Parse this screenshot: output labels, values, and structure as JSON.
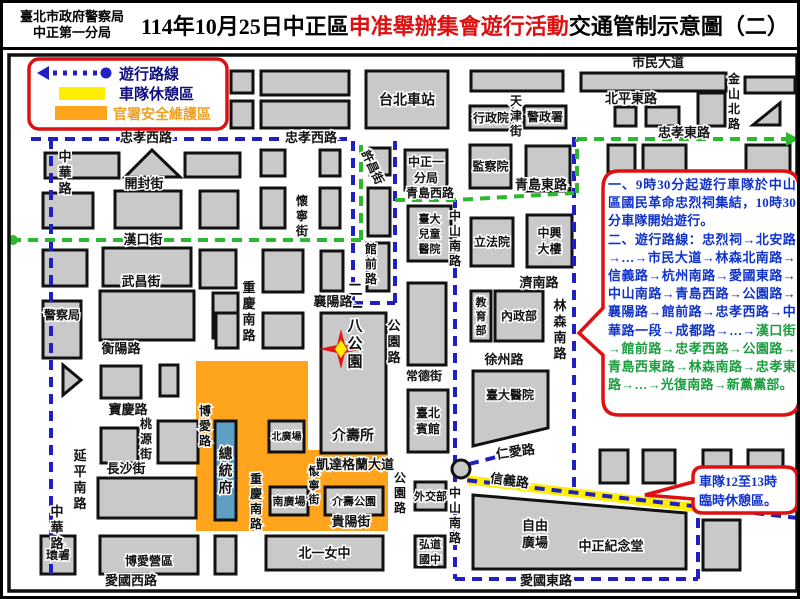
{
  "title": {
    "agency_line1": "臺北市政府警察局",
    "agency_line2": "中正第一分局",
    "part1": "114年10月25日中正區",
    "part2_red": "申准舉辦集會遊行活動",
    "part3": "交通管制示意圖（二）"
  },
  "legend": {
    "route_label": "遊行路線",
    "rest_label": "車隊休憩區",
    "security_label": "官署安全維護區"
  },
  "notes": {
    "para1": "一、9時30分起遊行車隊於中山區國民革命忠烈祠集結，10時30分車隊開始遊行。",
    "para2_blue": "二、遊行路線：忠烈祠→北安路→…→市民大道→林森北南路→信義路→杭州南路→愛國東路→中山南路→青島西路→公園路→襄陽路→館前路→忠孝西路→中華路一段→成都路→…→",
    "para2_green": "漢口街→館前路→忠孝西路→公園路→青島西東路→林森南路→忠孝東路→…→光復南路→新黨黨部。"
  },
  "callout": {
    "line1": "車隊12至13時",
    "line2": "臨時休憩區。"
  },
  "colors": {
    "block": "#c9c9c9",
    "block_border": "#111111",
    "orange_zone": "#ffa41c",
    "yellow_rest": "#ffee00",
    "route_blue": "#2020c0",
    "route_green": "#2db92d",
    "note_red": "#dd1111",
    "note_blue": "#1133cc",
    "note_green": "#1a9e3f",
    "president_fill": "#5f9fc4",
    "legend_text": "#101080",
    "legend_orange": "#f0a020"
  },
  "map": {
    "orange_zone_pts": "193,358 305,358 305,447 385,447 385,528 193,528",
    "yellow_band": {
      "x1": 465,
      "y1": 477,
      "x2": 697,
      "y2": 505
    },
    "buildings": [
      {
        "x": 228,
        "y": 68,
        "w": 22,
        "h": 22
      },
      {
        "x": 258,
        "y": 68,
        "w": 88,
        "h": 24
      },
      {
        "x": 228,
        "y": 98,
        "w": 22,
        "h": 27
      },
      {
        "x": 258,
        "y": 98,
        "w": 88,
        "h": 27
      },
      {
        "x": 363,
        "y": 68,
        "w": 82,
        "h": 57,
        "label": "台北車站",
        "fs": 14
      },
      {
        "x": 468,
        "y": 68,
        "w": 92,
        "h": 20
      },
      {
        "x": 467,
        "y": 103,
        "w": 42,
        "h": 24,
        "label": "行政院",
        "fs": 12
      },
      {
        "x": 521,
        "y": 103,
        "w": 42,
        "h": 22,
        "label": "警政署",
        "fs": 12
      },
      {
        "x": 578,
        "y": 70,
        "w": 145,
        "h": 18
      },
      {
        "x": 742,
        "y": 74,
        "w": 50,
        "h": 16
      },
      {
        "x": 612,
        "y": 104,
        "w": 21,
        "h": 19
      },
      {
        "x": 643,
        "y": 104,
        "w": 33,
        "h": 19
      },
      {
        "x": 695,
        "y": 90,
        "w": 27,
        "h": 33
      },
      {
        "pts": "750,122 777,122 777,100"
      },
      {
        "x": 605,
        "y": 142,
        "w": 27,
        "h": 27
      },
      {
        "x": 640,
        "y": 142,
        "w": 43,
        "h": 27
      },
      {
        "x": 743,
        "y": 142,
        "w": 44,
        "h": 27
      },
      {
        "x": 42,
        "y": 150,
        "w": 74,
        "h": 25
      },
      {
        "pts": "122,174 177,174 149,147"
      },
      {
        "x": 182,
        "y": 150,
        "w": 55,
        "h": 24
      },
      {
        "x": 258,
        "y": 147,
        "w": 24,
        "h": 26
      },
      {
        "x": 317,
        "y": 147,
        "w": 20,
        "h": 26
      },
      {
        "x": 367,
        "y": 145,
        "w": 20,
        "h": 27
      },
      {
        "x": 40,
        "y": 190,
        "w": 50,
        "h": 35
      },
      {
        "x": 112,
        "y": 188,
        "w": 66,
        "h": 37
      },
      {
        "x": 197,
        "y": 188,
        "w": 38,
        "h": 37
      },
      {
        "x": 258,
        "y": 185,
        "w": 24,
        "h": 40
      },
      {
        "x": 317,
        "y": 185,
        "w": 20,
        "h": 40
      },
      {
        "x": 365,
        "y": 185,
        "w": 22,
        "h": 48
      },
      {
        "x": 40,
        "y": 247,
        "w": 44,
        "h": 36
      },
      {
        "x": 100,
        "y": 245,
        "w": 88,
        "h": 38
      },
      {
        "x": 197,
        "y": 247,
        "w": 36,
        "h": 38
      },
      {
        "x": 260,
        "y": 247,
        "w": 40,
        "h": 42
      },
      {
        "x": 318,
        "y": 248,
        "w": 22,
        "h": 40
      },
      {
        "x": 364,
        "y": 240,
        "w": 22,
        "h": 48
      },
      {
        "x": 40,
        "y": 298,
        "w": 38,
        "h": 57,
        "label": "警察局",
        "fs": 12,
        "ly": 312
      },
      {
        "x": 97,
        "y": 288,
        "w": 94,
        "h": 49
      },
      {
        "x": 210,
        "y": 290,
        "w": 25,
        "h": 45
      },
      {
        "x": 213,
        "y": 310,
        "w": 22,
        "h": 35
      },
      {
        "x": 260,
        "y": 310,
        "w": 40,
        "h": 35
      },
      {
        "pts": "60,362 78,377 60,392"
      },
      {
        "x": 98,
        "y": 363,
        "w": 40,
        "h": 32
      },
      {
        "x": 157,
        "y": 362,
        "w": 18,
        "h": 31
      },
      {
        "x": 98,
        "y": 425,
        "w": 37,
        "h": 35
      },
      {
        "x": 155,
        "y": 418,
        "w": 40,
        "h": 42
      },
      {
        "x": 95,
        "y": 475,
        "w": 98,
        "h": 40
      },
      {
        "x": 38,
        "y": 533,
        "w": 34,
        "h": 38,
        "label": "環署",
        "fs": 12
      },
      {
        "x": 97,
        "y": 533,
        "w": 98,
        "h": 38,
        "label": "博愛營區",
        "fs": 12,
        "ly": 558
      },
      {
        "x": 212,
        "y": 533,
        "w": 21,
        "h": 38
      },
      {
        "x": 263,
        "y": 533,
        "w": 117,
        "h": 34,
        "label": "北一女中",
        "fs": 13
      },
      {
        "x": 402,
        "y": 147,
        "w": 42,
        "h": 40,
        "label": "中正一|分局",
        "fs": 12
      },
      {
        "x": 467,
        "y": 142,
        "w": 41,
        "h": 43,
        "label": "監察院",
        "fs": 12
      },
      {
        "x": 523,
        "y": 143,
        "w": 44,
        "h": 45
      },
      {
        "x": 468,
        "y": 215,
        "w": 42,
        "h": 48,
        "label": "立法院",
        "fs": 12
      },
      {
        "x": 524,
        "y": 212,
        "w": 45,
        "h": 52,
        "label": "中興|大樓",
        "fs": 12
      },
      {
        "x": 405,
        "y": 203,
        "w": 43,
        "h": 55,
        "label": "臺大|兒童|醫院",
        "fs": 11
      },
      {
        "x": 405,
        "y": 280,
        "w": 38,
        "h": 82
      },
      {
        "x": 468,
        "y": 288,
        "w": 20,
        "h": 50,
        "label": "教育部",
        "fs": 11,
        "vlabel": 1
      },
      {
        "x": 492,
        "y": 288,
        "w": 48,
        "h": 50,
        "label": "內政部",
        "fs": 12
      },
      {
        "pts": "470,368 545,368 545,425 470,443",
        "label": "臺大醫院",
        "fs": 12,
        "lx": 507,
        "ly": 392
      },
      {
        "x": 405,
        "y": 387,
        "w": 40,
        "h": 62,
        "label": "臺北|賓館",
        "fs": 12
      },
      {
        "x": 412,
        "y": 479,
        "w": 31,
        "h": 28,
        "label": "外交部",
        "fs": 11
      },
      {
        "x": 412,
        "y": 533,
        "w": 30,
        "h": 31,
        "label": "弘道|國中",
        "fs": 11
      },
      {
        "x": 318,
        "y": 310,
        "w": 65,
        "h": 140,
        "label": "二一八公園",
        "fs": 15,
        "vlabel": 1,
        "lx": 352,
        "ly": 322
      },
      {
        "x": 266,
        "y": 418,
        "w": 35,
        "h": 31,
        "label": "北廣場",
        "fs": 10
      },
      {
        "x": 267,
        "y": 484,
        "w": 38,
        "h": 28,
        "label": "南廣場",
        "fs": 11
      },
      {
        "x": 322,
        "y": 484,
        "w": 58,
        "h": 28,
        "label": "介壽公園",
        "fs": 11
      },
      {
        "x": 212,
        "y": 418,
        "w": 21,
        "h": 99,
        "label": "總統府",
        "fs": 14,
        "vlabel": 1,
        "fill": "president"
      },
      {
        "pts": "470,492 683,510 683,566 470,566",
        "label": "中正紀念堂",
        "fs": 13,
        "lx": 608,
        "ly": 543
      },
      {
        "x": 597,
        "y": 447,
        "w": 28,
        "h": 33
      },
      {
        "x": 640,
        "y": 447,
        "w": 32,
        "h": 33
      },
      {
        "x": 700,
        "y": 447,
        "w": 28,
        "h": 20
      },
      {
        "x": 745,
        "y": 447,
        "w": 35,
        "h": 28
      },
      {
        "x": 700,
        "y": 517,
        "w": 37,
        "h": 50
      }
    ],
    "streets": [
      {
        "t": "市民大道",
        "x": 655,
        "y": 64
      },
      {
        "t": "北平東路",
        "x": 628,
        "y": 100
      },
      {
        "t": "金山北路",
        "x": 731,
        "y": 80,
        "v": 1,
        "fs": 12
      },
      {
        "t": "忠孝東路",
        "x": 681,
        "y": 134
      },
      {
        "t": "天津街",
        "x": 513,
        "y": 102,
        "v": 1,
        "fs": 12
      },
      {
        "t": "忠孝西路",
        "x": 143,
        "y": 139
      },
      {
        "t": "忠孝西路",
        "x": 308,
        "y": 139
      },
      {
        "t": "中華路",
        "x": 62,
        "y": 158,
        "v": 1
      },
      {
        "t": "中華路",
        "x": 54,
        "y": 513,
        "v": 1
      },
      {
        "t": "開封街",
        "x": 141,
        "y": 185
      },
      {
        "t": "漢口街",
        "x": 140,
        "y": 241
      },
      {
        "t": "武昌街",
        "x": 138,
        "y": 283
      },
      {
        "t": "衡陽路",
        "x": 118,
        "y": 350
      },
      {
        "t": "襄陽路",
        "x": 330,
        "y": 303
      },
      {
        "t": "館前路",
        "x": 368,
        "y": 250,
        "v": 1,
        "fs": 12
      },
      {
        "t": "許昌街",
        "x": 366,
        "y": 166,
        "r": 65,
        "fs": 12
      },
      {
        "t": "懷寧街",
        "x": 299,
        "y": 202,
        "v": 1,
        "fs": 12
      },
      {
        "t": "懷寧街",
        "x": 311,
        "y": 472,
        "v": 1,
        "fs": 11
      },
      {
        "t": "重慶南路",
        "x": 246,
        "y": 289,
        "v": 1
      },
      {
        "t": "重慶南路",
        "x": 253,
        "y": 480,
        "v": 1,
        "fs": 12
      },
      {
        "t": "青島西路",
        "x": 427,
        "y": 194,
        "fs": 12
      },
      {
        "t": "青島東路",
        "x": 538,
        "y": 186
      },
      {
        "t": "公園路",
        "x": 391,
        "y": 327,
        "v": 1
      },
      {
        "t": "公園路",
        "x": 397,
        "y": 479,
        "v": 1,
        "fs": 12
      },
      {
        "t": "常德街",
        "x": 421,
        "y": 377,
        "fs": 12
      },
      {
        "t": "徐州路",
        "x": 501,
        "y": 361
      },
      {
        "t": "濟南路",
        "x": 536,
        "y": 284
      },
      {
        "t": "林森南路",
        "x": 557,
        "y": 307,
        "v": 1
      },
      {
        "t": "中山南路",
        "x": 452,
        "y": 217,
        "v": 1,
        "fs": 12
      },
      {
        "t": "中山南路",
        "x": 452,
        "y": 494,
        "v": 1,
        "fs": 12
      },
      {
        "t": "凱達格蘭大道",
        "x": 352,
        "y": 466
      },
      {
        "t": "貴陽街",
        "x": 348,
        "y": 523
      },
      {
        "t": "長沙街",
        "x": 123,
        "y": 470
      },
      {
        "t": "桃源街",
        "x": 143,
        "y": 425,
        "v": 1,
        "fs": 12
      },
      {
        "t": "寶慶路",
        "x": 125,
        "y": 411
      },
      {
        "t": "博愛路",
        "x": 202,
        "y": 412,
        "v": 1,
        "fs": 12
      },
      {
        "t": "延平南路",
        "x": 77,
        "y": 457,
        "v": 1
      },
      {
        "t": "愛國西路",
        "x": 128,
        "y": 582
      },
      {
        "t": "愛國東路",
        "x": 543,
        "y": 582
      },
      {
        "t": "仁愛路",
        "x": 513,
        "y": 453,
        "r": -8
      },
      {
        "t": "信義路",
        "x": 506,
        "y": 482,
        "r": 8
      },
      {
        "t": "介壽所",
        "x": 350,
        "y": 437,
        "fs": 14
      },
      {
        "t": "自由廣場",
        "x": 532,
        "y": 531,
        "lines": "自由|廣場"
      }
    ]
  }
}
